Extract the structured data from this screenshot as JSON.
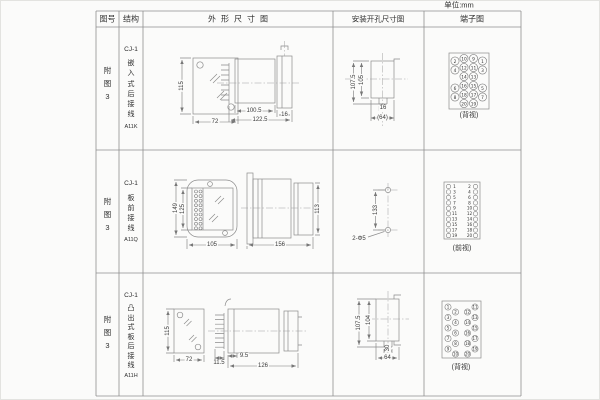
{
  "unit_label": "单位:mm",
  "headers": {
    "fig_no": "图号",
    "structure": "结构",
    "outline": "外形尺寸图",
    "mounting": "安装开孔尺寸图",
    "terminal": "端子图"
  },
  "rows": [
    {
      "fig_no": "附图3",
      "model": "CJ-1",
      "mount_type": "嵌入式后接线",
      "code": "A11K",
      "outline": {
        "front_h": "115",
        "front_w": "72",
        "body_d": "100.5",
        "total_d": "122.5",
        "flange_d": "16"
      },
      "mounting": {
        "h1": "107.5",
        "h2": "105",
        "w1": "16",
        "w2": "(64)"
      },
      "terminal_caption": "(背视)"
    },
    {
      "fig_no": "附图3",
      "model": "CJ-1",
      "mount_type": "板前接线",
      "code": "A11Q",
      "outline": {
        "front_h": "149",
        "inner_h": "125",
        "front_w": "105",
        "total_d": "156",
        "side_h": "113"
      },
      "mounting": {
        "hole_dist": "133",
        "hole_label": "2-Φ5"
      },
      "terminal_caption": "(前视)"
    },
    {
      "fig_no": "附图3",
      "model": "CJ-1",
      "mount_type": "凸出式板后接线",
      "code": "A11H",
      "outline": {
        "front_h": "115",
        "front_w": "72",
        "pin_d": "11.5",
        "gap": "9.5",
        "total_d": "126"
      },
      "mounting": {
        "h1": "107.5",
        "h2": "104",
        "w1": "30",
        "w2": "64"
      },
      "terminal_caption": "(背视)"
    }
  ],
  "terminals": {
    "row1": {
      "outer_left": [
        "2",
        "4",
        "6",
        "8"
      ],
      "inner_left": [
        "10",
        "12",
        "14",
        "16",
        "18",
        "20"
      ],
      "inner_right": [
        "9",
        "11",
        "13",
        "15",
        "17",
        "19"
      ],
      "outer_right": [
        "1",
        "3",
        "5",
        "7"
      ]
    },
    "row2": {
      "left": [
        "1",
        "3",
        "5",
        "7",
        "9",
        "11",
        "13",
        "15",
        "17",
        "19"
      ],
      "right": [
        "2",
        "4",
        "6",
        "8",
        "10",
        "12",
        "14",
        "16",
        "18",
        "20"
      ]
    },
    "row3": {
      "outer_left": [
        "1",
        "3",
        "5",
        "7",
        "9"
      ],
      "inner_left": [
        "2",
        "4",
        "6",
        "8",
        "10"
      ],
      "inner_right": [
        "12",
        "14",
        "16",
        "18",
        "20"
      ],
      "outer_right": [
        "11",
        "13",
        "15",
        "17",
        "19"
      ]
    }
  },
  "colors": {
    "line": "#8b8b8b",
    "text": "#2f2f2f",
    "background": "#fbfbfa"
  }
}
